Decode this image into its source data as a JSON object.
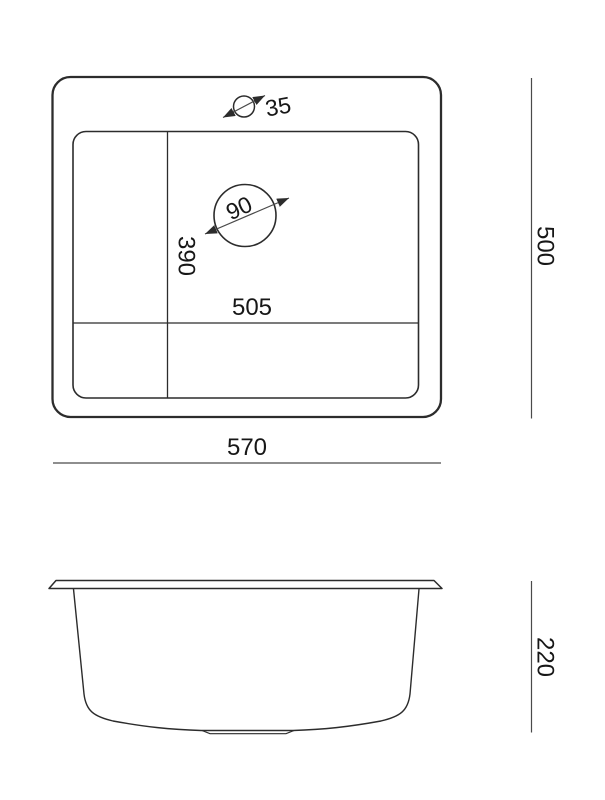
{
  "drawing": {
    "type": "sink-technical-drawing",
    "views": {
      "top": {
        "dim_faucet_hole": "35",
        "dim_drain": "90",
        "dim_bowl_length": "390",
        "dim_bowl_width": "505",
        "dim_overall_width": "570",
        "dim_overall_depth": "500"
      },
      "side": {
        "dim_height": "220"
      }
    },
    "colors": {
      "outline": "#2c2c2c",
      "dimension_line": "#4a4a4a",
      "label": "#171717",
      "background": "#ffffff"
    }
  }
}
